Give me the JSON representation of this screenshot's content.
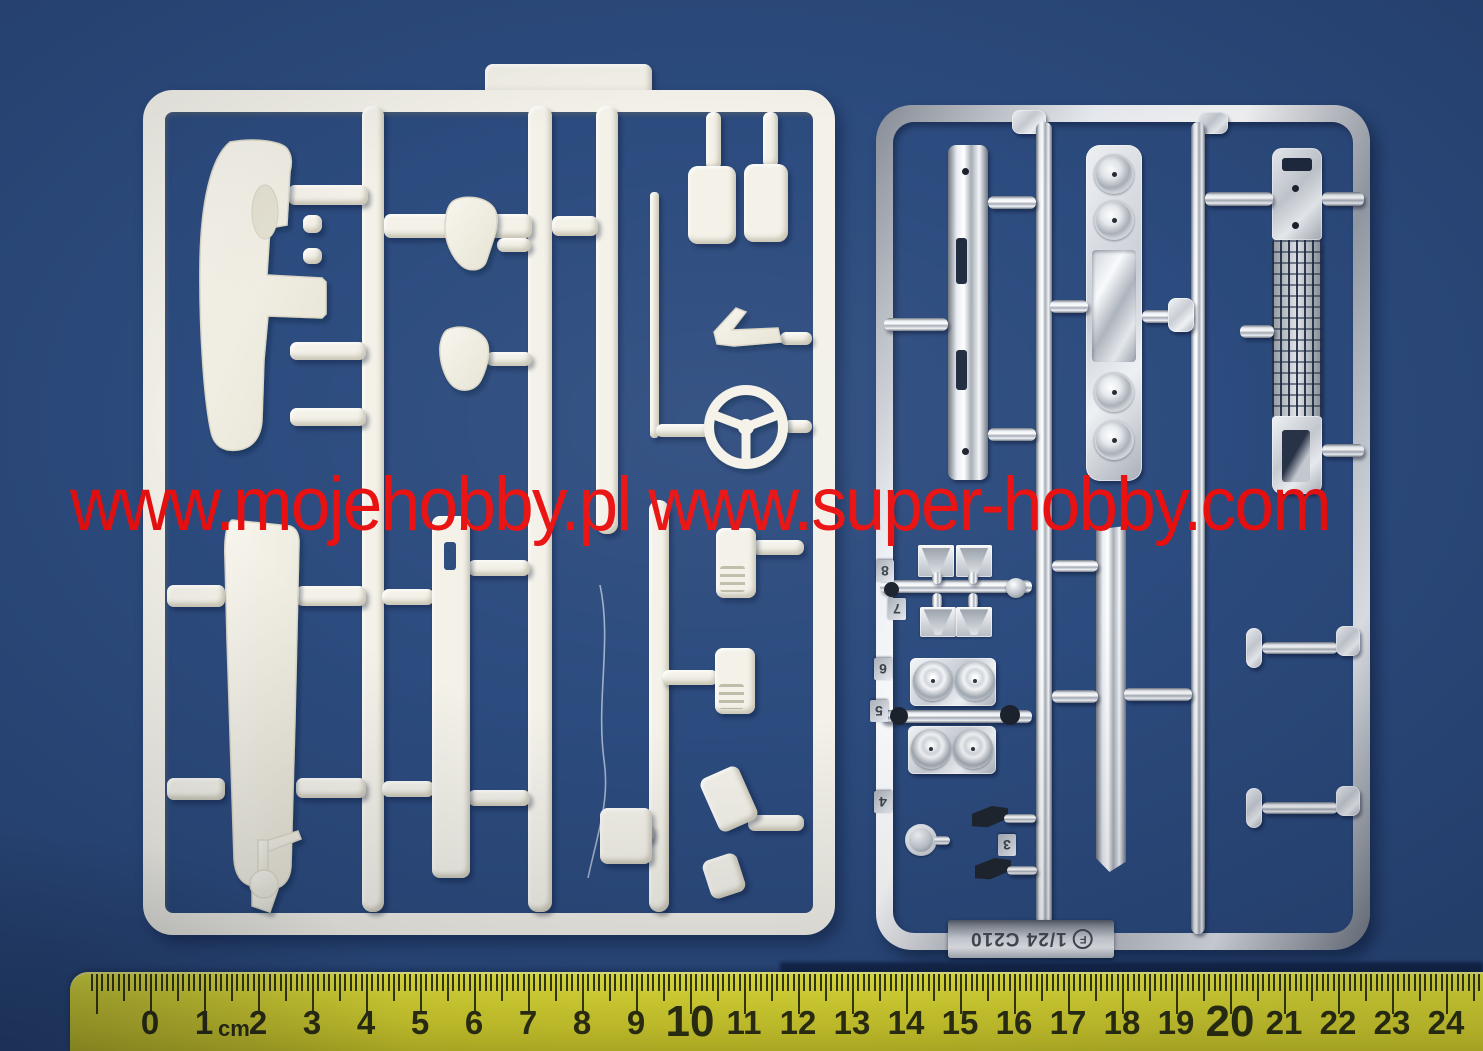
{
  "scene": {
    "background_color": "#2c4b7e",
    "white_plastic_color": "#f3f1e8",
    "chrome_highlight_color": "#ffffff"
  },
  "watermark": {
    "text": "www.mojehobby.pl www.super-hobby.com",
    "color": "#e90f0f"
  },
  "chrome_sprue": {
    "part_labels": [
      "8",
      "7",
      "6",
      "5",
      "4",
      "3"
    ],
    "tag": {
      "logo": "F",
      "text": "1/24 C210"
    }
  },
  "ruler": {
    "unit": "cm",
    "numbers": [
      "0",
      "1",
      "2",
      "3",
      "4",
      "5",
      "6",
      "7",
      "8",
      "9",
      "10",
      "11",
      "12",
      "13",
      "14",
      "15",
      "16",
      "17",
      "18",
      "19",
      "20",
      "21",
      "22",
      "23",
      "24"
    ],
    "emphasized": [
      "10",
      "20"
    ],
    "body_color": "#e8e432",
    "tick_color": "#3a3c12",
    "number_color": "#2f3110"
  }
}
